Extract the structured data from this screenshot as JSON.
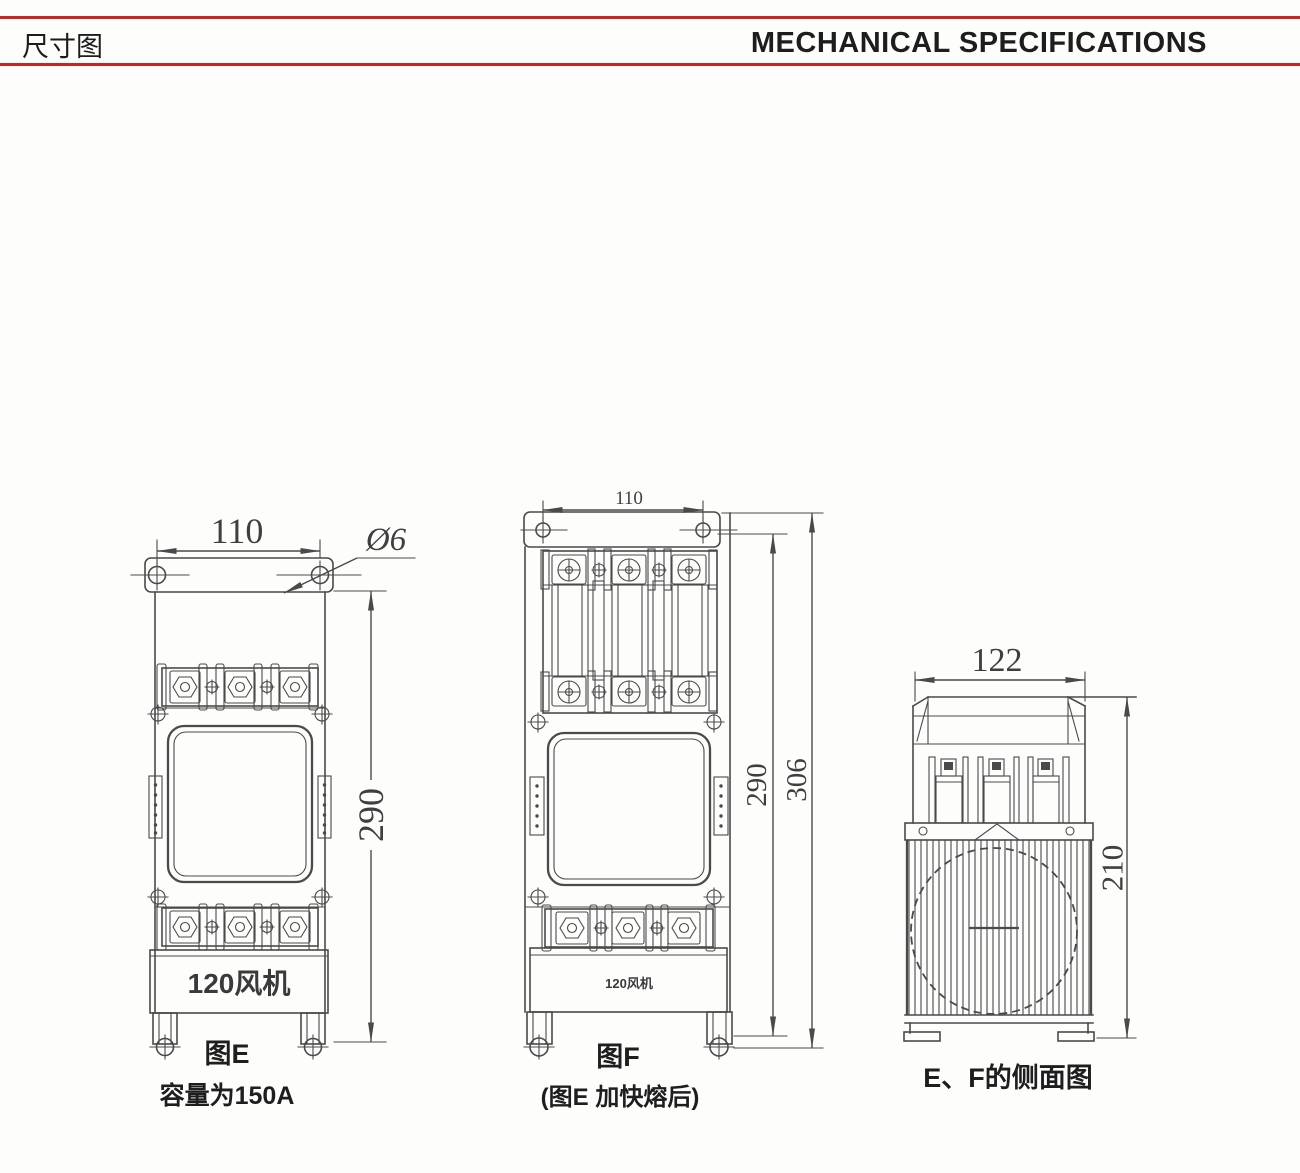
{
  "header": {
    "title_zh": "尺寸图",
    "title_en": "MECHANICAL SPECIFICATIONS"
  },
  "colors": {
    "accent_red": "#c9241e",
    "line_gray": "#4a4a4a"
  },
  "figures": {
    "e": {
      "dim_width": "110",
      "dim_hole_dia": "Ø6",
      "dim_height": "290",
      "fan_label": "120风机",
      "caption": "图E",
      "subcaption": "容量为150A"
    },
    "f": {
      "dim_width": "110",
      "dim_height_inner": "290",
      "dim_height_outer": "306",
      "fan_label": "120风机",
      "caption": "图F",
      "subcaption": "(图E 加快熔后)"
    },
    "side": {
      "dim_width": "122",
      "dim_height": "210",
      "caption": "E、F的侧面图"
    }
  }
}
